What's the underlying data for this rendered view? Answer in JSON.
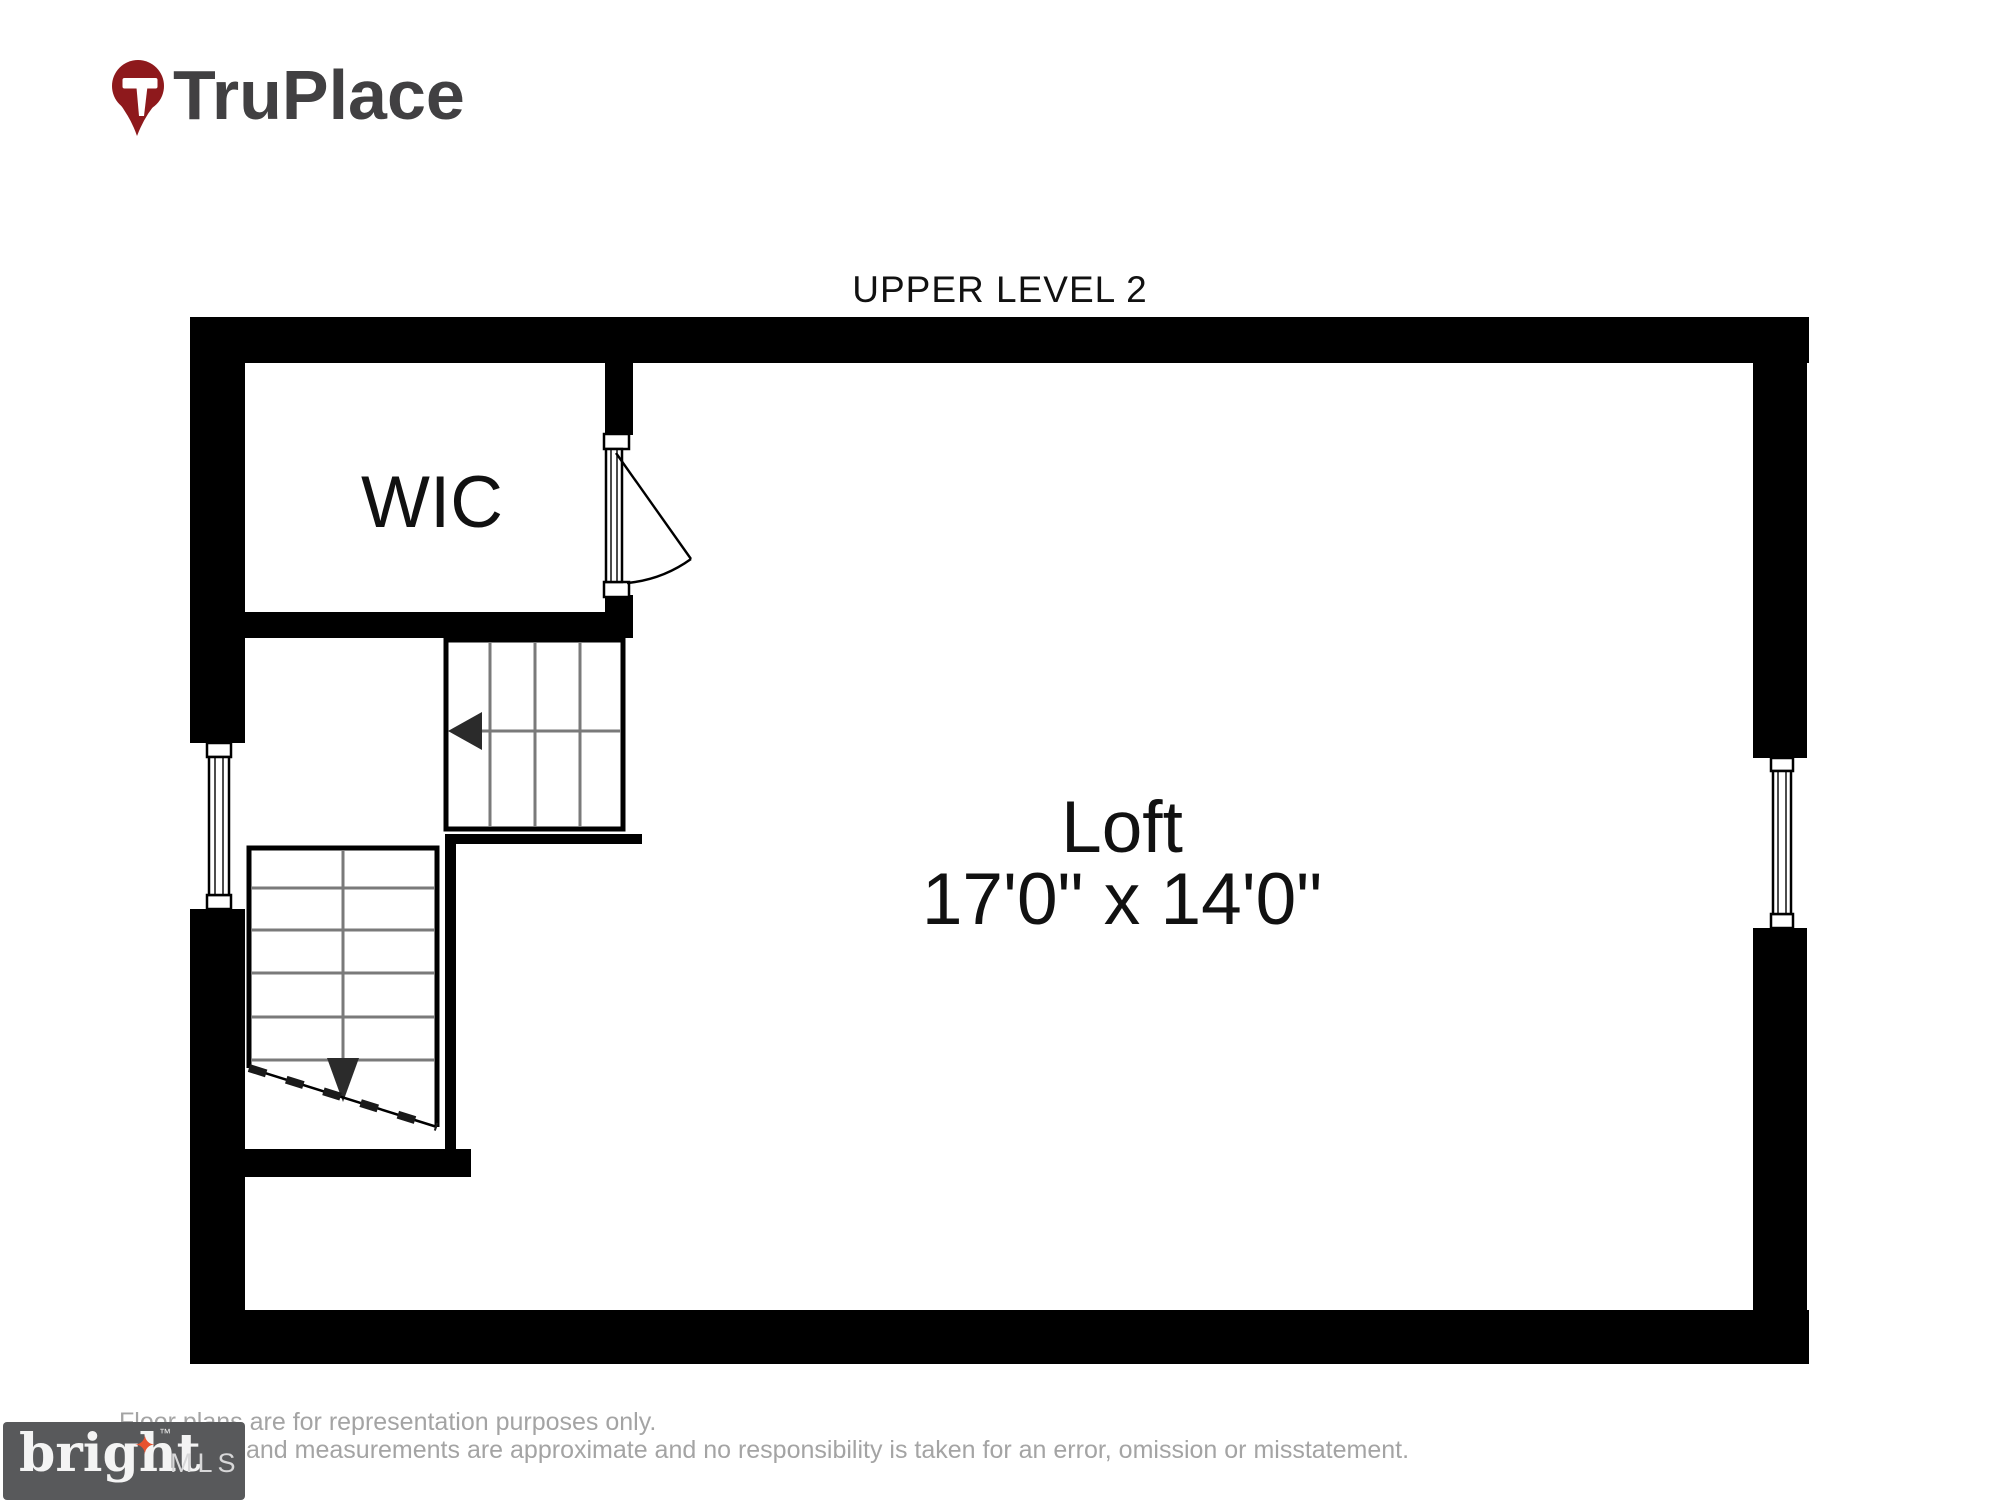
{
  "logo": {
    "brand": "TruPlace",
    "pin_color": "#8e191c",
    "text_color": "#414042"
  },
  "plan": {
    "title": "UPPER LEVEL 2",
    "rooms": {
      "wic": {
        "label": "WIC"
      },
      "loft": {
        "label": "Loft",
        "dimensions": "17'0\" x 14'0\""
      }
    }
  },
  "footer": {
    "disclaimer_line1": "Floor plans are for representation purposes only.",
    "disclaimer_line2": "and measurements are approximate and no responsibility is taken for an error, omission or misstatement.",
    "mls": {
      "brand": "bright",
      "suffix": "MLS",
      "tm": "™",
      "box_color": "#58595b",
      "star_color": "#e8522f"
    }
  },
  "colors": {
    "wall": "#000000",
    "tread_line": "#7a7a7a",
    "label_text": "#111111",
    "disclaimer_text": "#a4a4a4",
    "logo_pin": "#8e191c",
    "logo_text": "#414042",
    "mls_box": "#58595b",
    "mls_star": "#e8522f"
  }
}
